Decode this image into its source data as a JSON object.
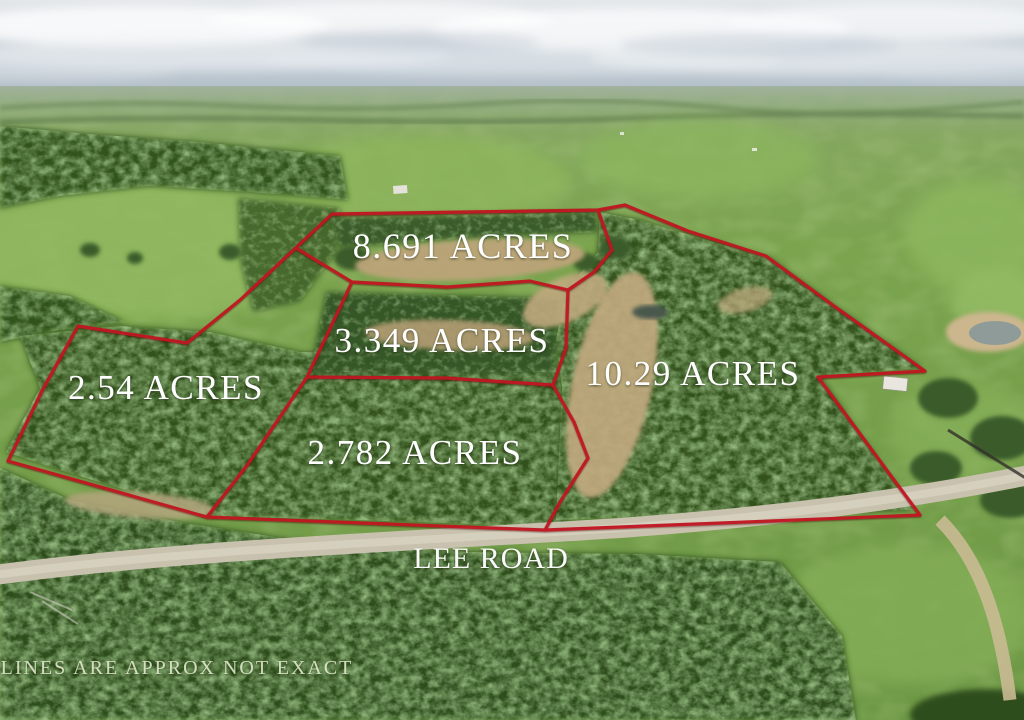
{
  "scene": {
    "type": "aerial-drone-photo-of-land-parcels",
    "road_label": "LEE ROAD",
    "disclaimer": "LINES ARE APPROX NOT EXACT"
  },
  "parcels": [
    {
      "id": "lot-8691",
      "label": "8.691 ACRES",
      "acres": 8.691
    },
    {
      "id": "lot-3349",
      "label": "3.349 ACRES",
      "acres": 3.349
    },
    {
      "id": "lot-254",
      "label": "2.54 ACRES",
      "acres": 2.54
    },
    {
      "id": "lot-1029",
      "label": "10.29 ACRES",
      "acres": 10.29
    },
    {
      "id": "lot-2782",
      "label": "2.782 ACRES",
      "acres": 2.782
    }
  ],
  "colors": {
    "boundary_red": "#c01820",
    "label_text": "#ffffff",
    "disclaimer_text": "#e4eecf",
    "road_gray": "#c8c1ae",
    "sky_gray_blue": "#b9c4cd",
    "field_green": "#79a24c",
    "tree_green": "#35541f",
    "dirt_tan": "#bca379"
  }
}
